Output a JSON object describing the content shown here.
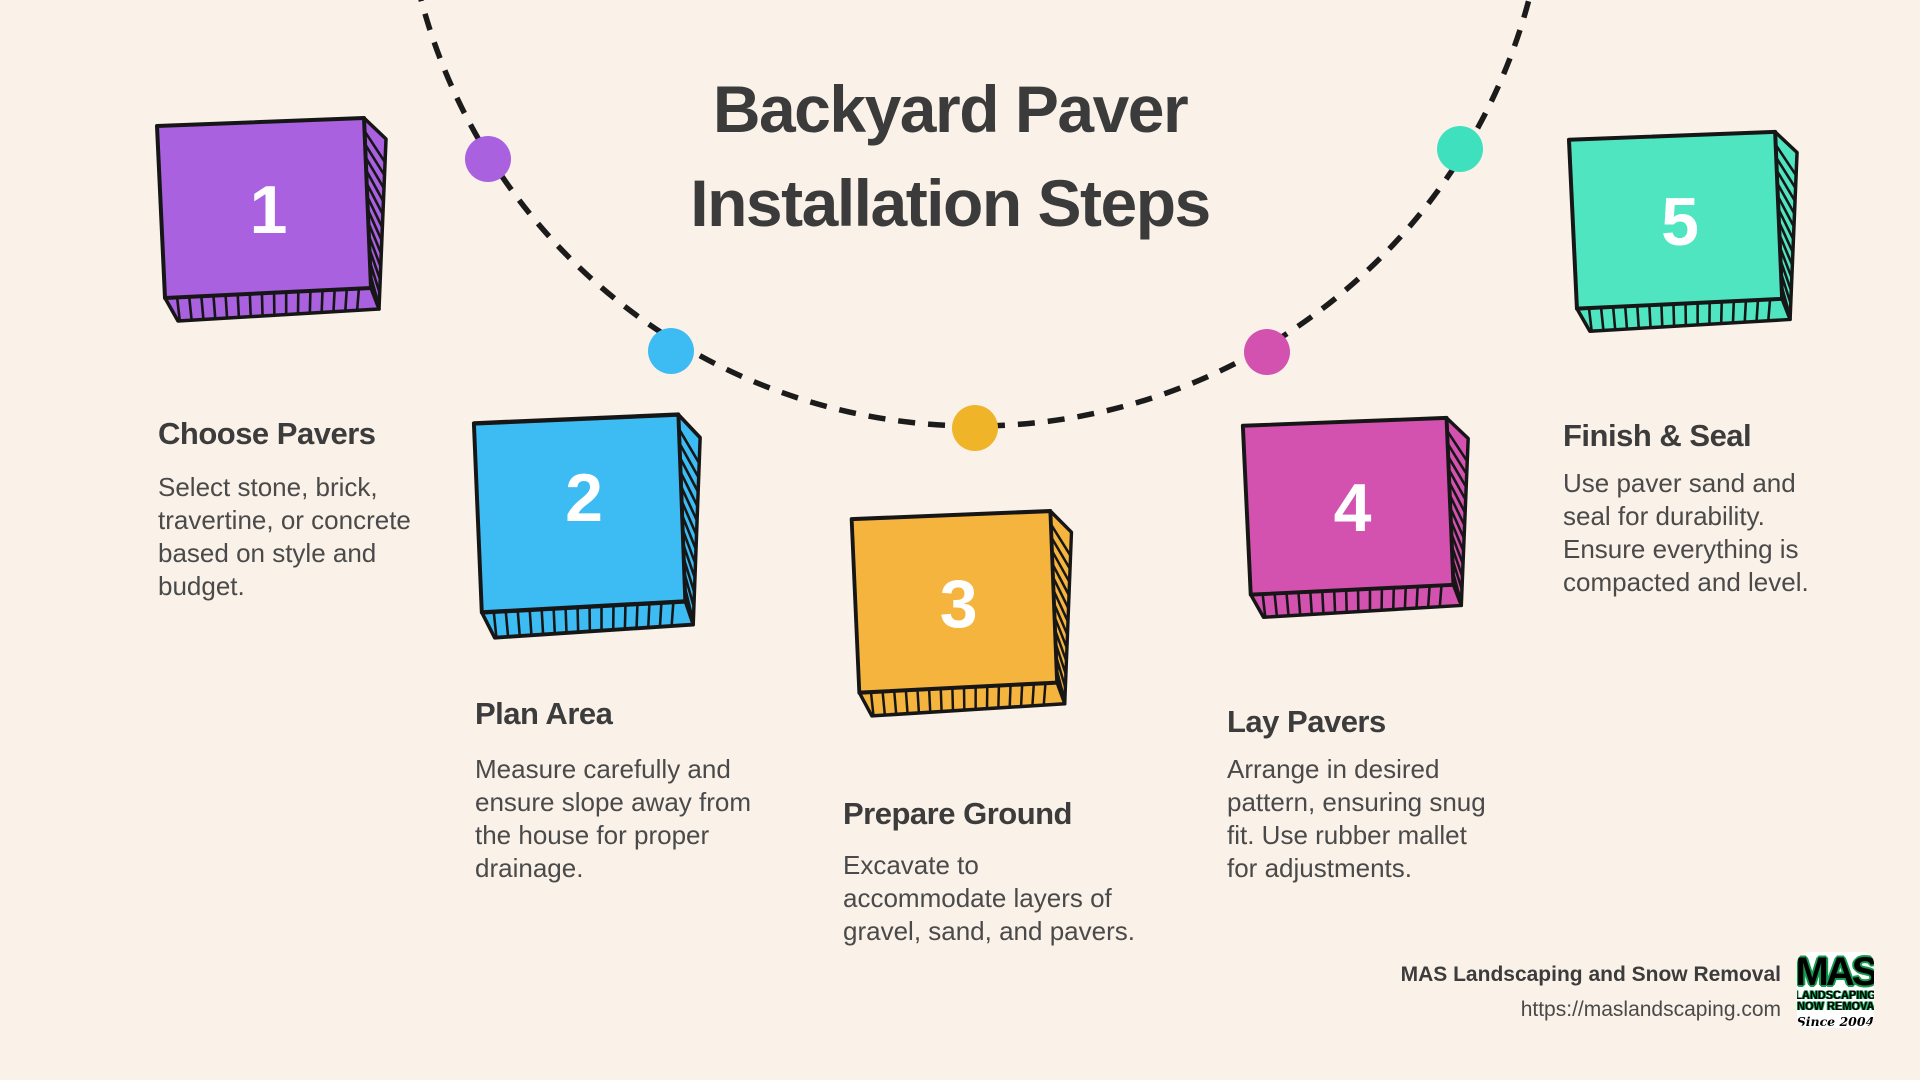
{
  "title": {
    "line1": "Backyard Paver",
    "line2": "Installation Steps"
  },
  "steps": [
    {
      "number": "1",
      "color": "#A961E0",
      "heading": "Choose Pavers",
      "body": "Select stone, brick,\ntravertine, or concrete\nbased on style and\nbudget."
    },
    {
      "number": "2",
      "color": "#3DBCF4",
      "heading": "Plan Area",
      "body": "Measure carefully and\nensure slope away from\nthe house for proper\ndrainage."
    },
    {
      "number": "3",
      "color": "#F5B43E",
      "heading": "Prepare Ground",
      "body": "Excavate to\naccommodate layers of\ngravel, sand, and pavers."
    },
    {
      "number": "4",
      "color": "#D351AF",
      "heading": "Lay Pavers",
      "body": "Arrange in desired\npattern, ensuring snug\nfit. Use rubber mallet\nfor adjustments."
    },
    {
      "number": "5",
      "color": "#4FE5C1",
      "heading": "Finish & Seal",
      "body": "Use paver sand and\nseal for durability.\nEnsure everything is\ncompacted and level."
    }
  ],
  "arc": {
    "line_color": "#1B1B1B",
    "dot_colors": [
      "#A961E0",
      "#3DBCF4",
      "#F0B429",
      "#D351AF",
      "#3FE0BE"
    ]
  },
  "footer": {
    "company": "MAS Landscaping and Snow Removal",
    "url": "https://maslandscaping.com",
    "logo": {
      "line1": "MAS",
      "line2": "LANDSCAPING",
      "line3": "SNOW REMOVAL",
      "line4": "Since 2004",
      "green": "#169A4F"
    }
  },
  "colors": {
    "background": "#FAF1E8"
  }
}
